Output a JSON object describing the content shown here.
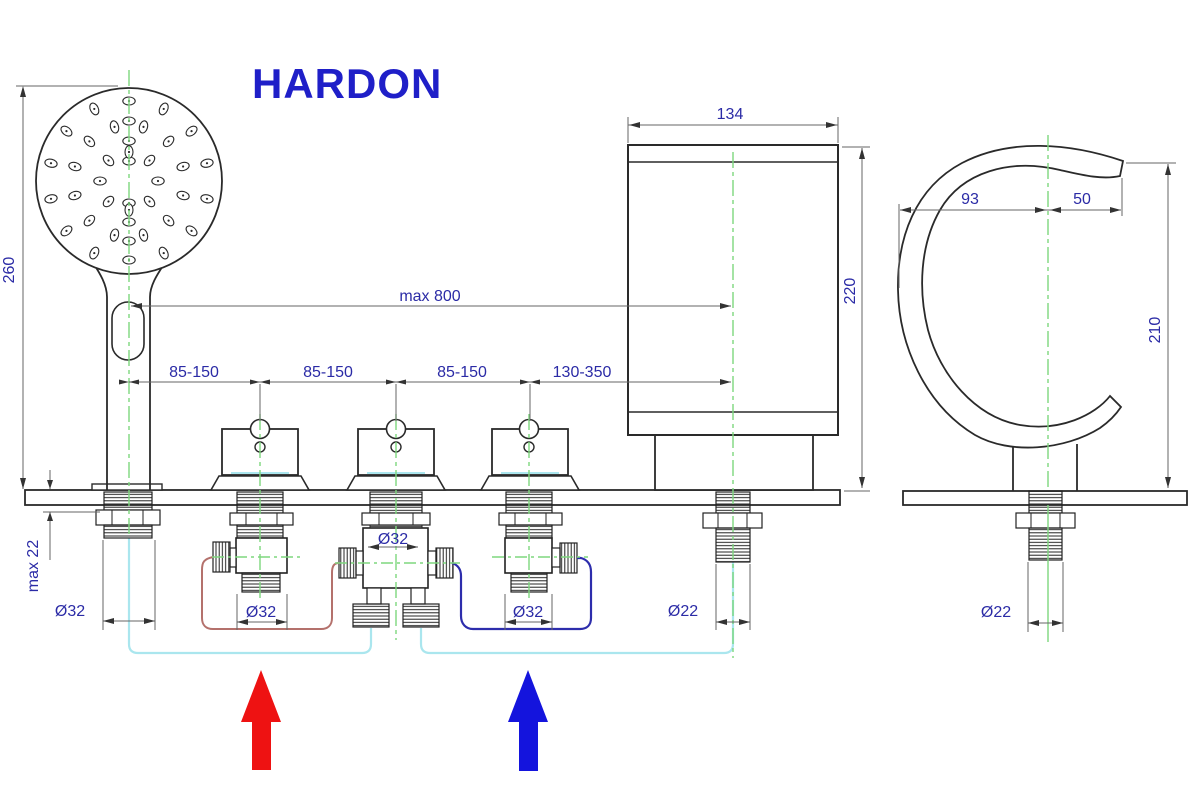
{
  "title": "HARDON",
  "drawing": "5-hole bath mixer installation diagram",
  "dims": {
    "shower_length": "260",
    "deck_thickness": "max 22",
    "shower_hole": "Ø32",
    "valve1_hole": "Ø32",
    "diverter_hole": "Ø32",
    "valve3_hole": "Ø32",
    "spout_hole": "Ø22",
    "side_view_hole": "Ø22",
    "hose_reach": "max 800",
    "spacing": [
      "85-150",
      "85-150",
      "85-150",
      "130-350"
    ],
    "spout_body_width": "134",
    "spout_body_height": "220",
    "spout_back_reach": "93",
    "spout_front_reach": "50",
    "side_view_height": "210"
  },
  "symbols": {
    "hot_inlet": "up-arrow",
    "cold_inlet": "up-arrow"
  },
  "colors": {
    "title_blue": "#1f1fc8",
    "dim_text_blue": "#2b2ba6",
    "object_line": "#2a2a2a",
    "dim_line": "#666666",
    "centerline_green": "#7ed77e",
    "feed_hose_cyan": "#aae6ee",
    "hot_hose": "#b4716c",
    "cold_hose": "#2d2dac",
    "hot_arrow_red": "#ee1212",
    "cold_arrow_blue": "#1414dd",
    "background": "#ffffff"
  }
}
